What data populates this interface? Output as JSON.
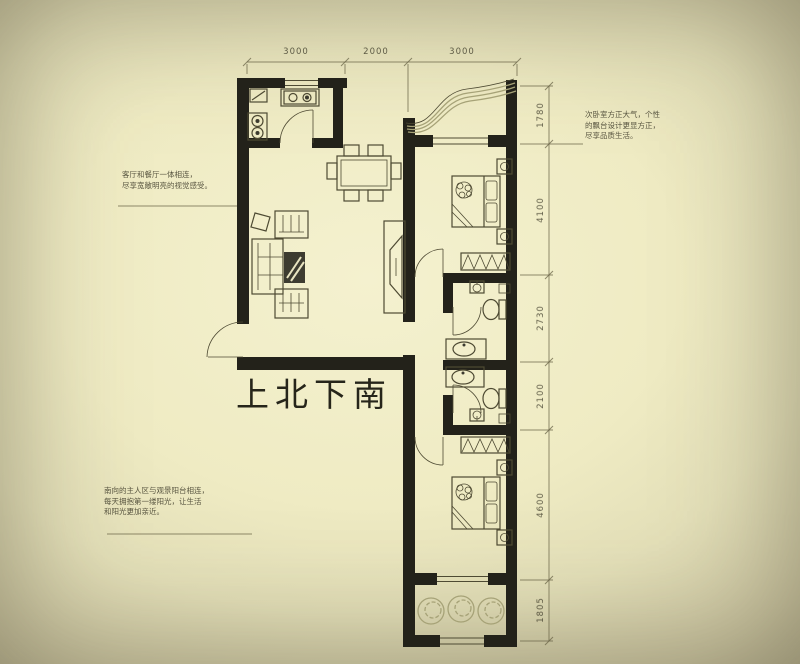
{
  "orientation_label": "上北下南",
  "dimensions": {
    "top": [
      "3000",
      "2000",
      "3000"
    ],
    "right": [
      "1780",
      "4100",
      "2730",
      "2100",
      "4600",
      "1805"
    ]
  },
  "annotations": {
    "living_room_note": {
      "lines": [
        "客厅和餐厅一体相连，",
        "尽享宽敞明亮的视觉感受。"
      ]
    },
    "secondary_bedroom_note": {
      "lines": [
        "次卧室方正大气，个性",
        "的飘台设计更显方正，",
        "尽享品质生活。"
      ]
    },
    "master_bedroom_note": {
      "lines": [
        "南向的主人区与观景阳台相连，",
        "每天拥抱第一缕阳光，让生活",
        "和阳光更加亲近。"
      ]
    }
  },
  "colors": {
    "background_center": "#f4f1cf",
    "background_edge": "#b5af8f",
    "wall": "#23221a",
    "line": "#4e4a33",
    "dim_line": "#6b6648",
    "text": "#3e3b2a",
    "accent_light": "#a6a277"
  }
}
